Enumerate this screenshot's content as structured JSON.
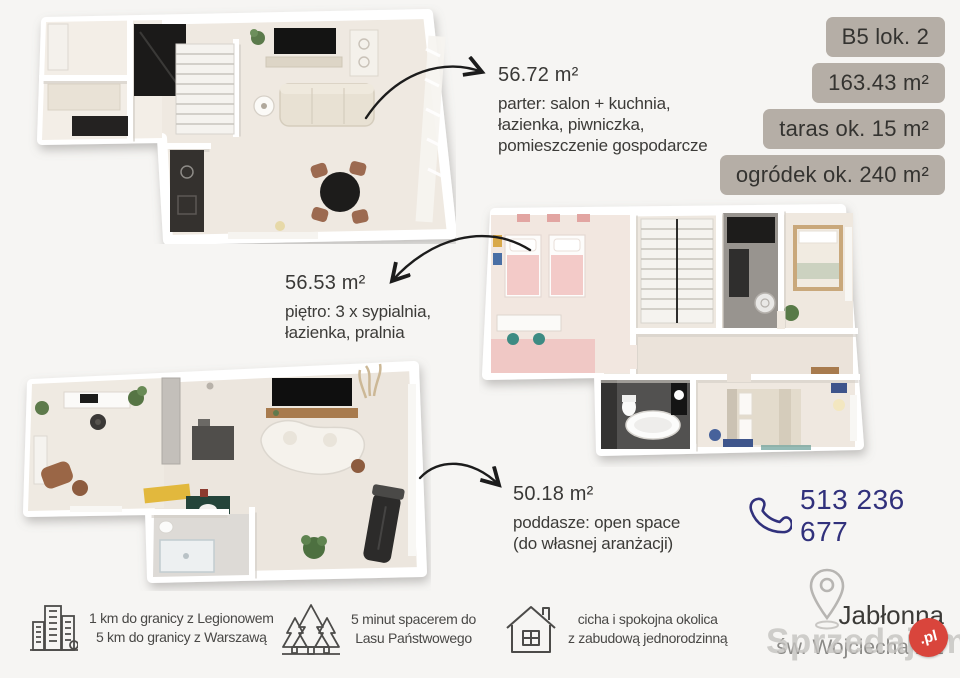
{
  "badges": {
    "unit": "B5 lok. 2",
    "total_area": "163.43 m²",
    "terrace": "taras ok. 15 m²",
    "garden": "ogródek ok. 240 m²"
  },
  "floors": [
    {
      "id": "parter",
      "area": "56.72 m²",
      "desc_lines": [
        "parter: salon + kuchnia,",
        "łazienka, piwniczka,",
        "pomieszczenie gospodarcze"
      ]
    },
    {
      "id": "pietro",
      "area": "56.53 m²",
      "desc_lines": [
        "piętro: 3 x sypialnia,",
        "łazienka, pralnia"
      ]
    },
    {
      "id": "poddasze",
      "area": "50.18 m²",
      "desc_lines": [
        "poddasze: open space",
        "(do własnej aranżacji)"
      ]
    }
  ],
  "contact": {
    "phone": "513 236 677",
    "phone_icon": "phone-icon"
  },
  "location": {
    "pin_icon": "map-pin-icon",
    "city": "Jabłonna",
    "street": "św. Wojciecha 1/2"
  },
  "features": [
    {
      "icon": "city-buildings-icon",
      "lines": [
        "1 km do granicy z Legionowem",
        "5 km do granicy z Warszawą"
      ]
    },
    {
      "icon": "forest-trees-icon",
      "lines": [
        "5 minut spacerem do",
        "Lasu Państwowego"
      ]
    },
    {
      "icon": "house-icon",
      "lines": [
        "cicha i spokojna okolica",
        "z zabudową jednorodzinną"
      ]
    }
  ],
  "watermark": {
    "brand": "Sprzedajemy",
    "tld": ".pl"
  },
  "colors": {
    "background": "#f6f5f3",
    "badge_bg": "#b5aea6",
    "text_dark": "#3c3b38",
    "text_muted": "#8b8a87",
    "phone_navy": "#31317c",
    "watermark_red": "#d9453c",
    "arrow_black": "#1c1c1c"
  }
}
